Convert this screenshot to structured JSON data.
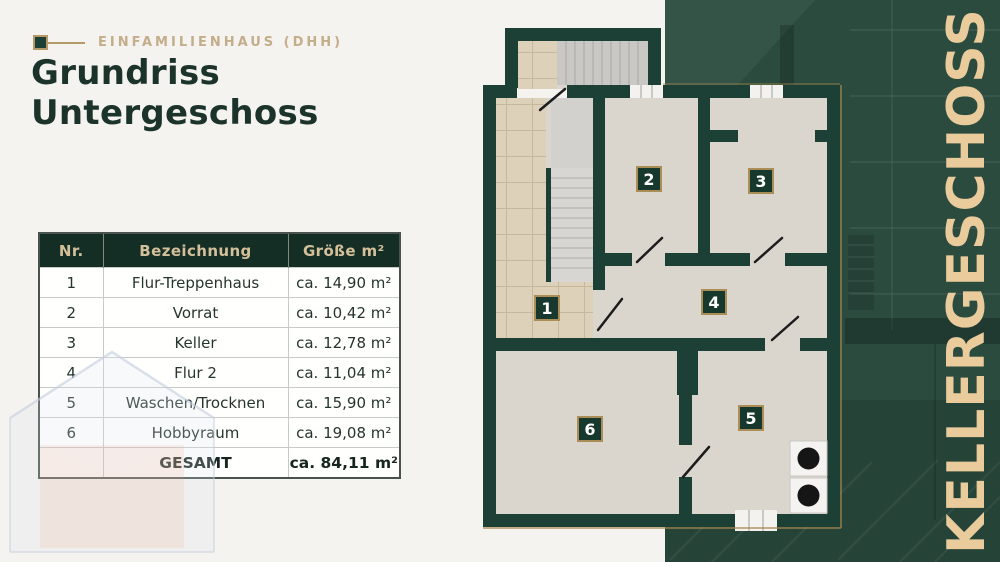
{
  "header": {
    "eyebrow": "EINFAMILIENHAUS (DHH)",
    "title_line1": "Grundriss",
    "title_line2": "Untergeschoss"
  },
  "table": {
    "columns": [
      "Nr.",
      "Bezeichnung",
      "Größe m²"
    ],
    "rows": [
      {
        "nr": "1",
        "name": "Flur-Treppenhaus",
        "size": "ca. 14,90 m²"
      },
      {
        "nr": "2",
        "name": "Vorrat",
        "size": "ca. 10,42 m²"
      },
      {
        "nr": "3",
        "name": "Keller",
        "size": "ca. 12,78 m²"
      },
      {
        "nr": "4",
        "name": "Flur 2",
        "size": "ca. 11,04 m²"
      },
      {
        "nr": "5",
        "name": "Waschen/Trocknen",
        "size": "ca. 15,90 m²"
      },
      {
        "nr": "6",
        "name": "Hobbyraum",
        "size": "ca. 19,08 m²"
      }
    ],
    "total": {
      "label": "GESAMT",
      "size": "ca. 84,11 m²"
    }
  },
  "floorplan": {
    "badges": [
      "1",
      "2",
      "3",
      "4",
      "5",
      "6"
    ]
  },
  "side_banner": {
    "label": "KELLERGESCHOSS"
  },
  "colors": {
    "background": "#f5f3f0",
    "wall_green": "#1d4036",
    "panel_green": "#2b4b3f",
    "gold": "#ab8d57",
    "eyebrow_tan": "#c4ad8a",
    "banner_text": "#e9cb9c",
    "table_header_bg": "#152e25",
    "table_header_text": "#d3c09a",
    "title_text": "#1b332a"
  }
}
